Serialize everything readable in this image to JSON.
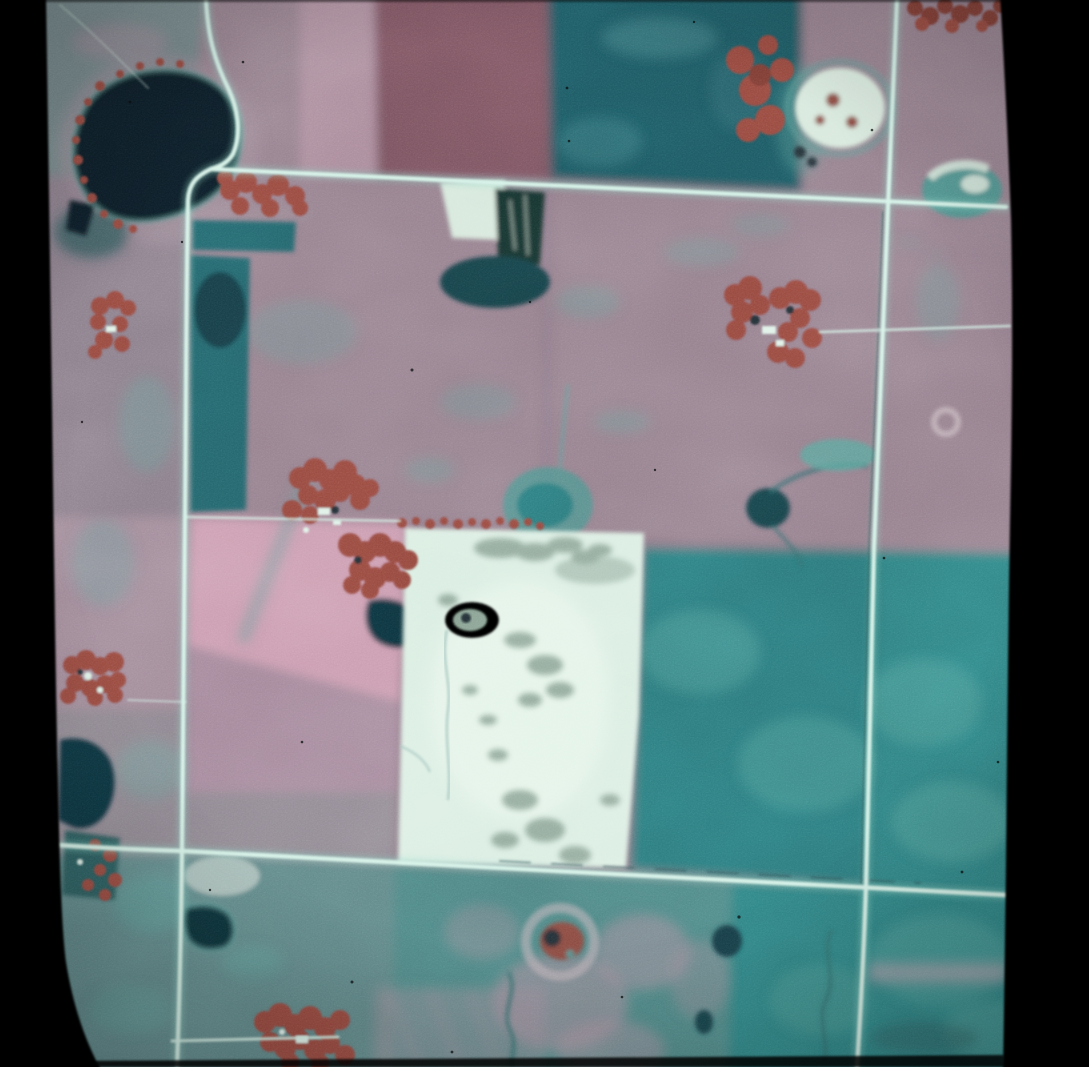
{
  "meta": {
    "type": "false-color infrared aerial photograph (film slide)",
    "description": "Vertical false-color infrared aerial photo of agricultural section-road grid with fields in magenta-mauve and teal tones, a dark kettle lake at upper left, farmstead shelterbelts rendered dark red, sloughs and ponds in dark teal, and one bright white-cream fallow field at center. Black film-mount borders run along the left and right edges.",
    "width_px": 1089,
    "height_px": 1067
  },
  "palette": {
    "base": "#8d7685",
    "grayTeal": "#74878a",
    "mauve": "#957f8d",
    "mauveGray": "#8b7e8b",
    "pinkGray": "#a18a99",
    "pinkPale": "#b492a3",
    "redField": "#7b5260",
    "tealDark": "#1d5962",
    "tealStrip": "#24646b",
    "tealBand": "#2b7a7d",
    "tealBand2": "#2e8283",
    "bottomTeal": "#4d8685",
    "bottomTealGray": "#5f8687",
    "pink": "#cb9cb0",
    "pinkDim": "#a98da0",
    "grayMid": "#8f8791",
    "whiteField": "#dbeee3",
    "whiteBright": "#ecf8ee",
    "mottle": "#87a091",
    "lake": "#0c1f27",
    "lakeSouth": "#10333c",
    "pond": "#123a44",
    "pondDark": "#0d2d35",
    "pondMid": "#153f47",
    "trees": "#96473e",
    "treesDark": "#7e3a33",
    "conifer": "#17332e",
    "farmWhite": "#dff2e8",
    "slough": "#d7e8dc",
    "marsh": "#2c5a5b",
    "palePatch": "#b7c9c3",
    "redBlob": "#8a4940",
    "darkSpot": "#202f35",
    "road": "#d4f2e7",
    "roadGlow": "#8fd8c8",
    "channel": "#2e6a6c",
    "channelLight": "#9fc3bb",
    "fringe": "#5d9b97",
    "shoulder": "#24454a",
    "ringPale": "#c7b6bd",
    "pinkFringe": "#c795aa",
    "tealPatch": "#58a59d",
    "tealBlob": "#4f928e",
    "cloud": "#35747b",
    "pinkMottle": "#b38fa0",
    "paleBand": "#c2a2b0",
    "filmBlack": "#060606"
  },
  "scene": {
    "features": [
      {
        "name": "kettle-lake",
        "desc": "dark lake upper left with red-toned tree fringe"
      },
      {
        "name": "red-crop-field",
        "desc": "dark magenta rectangular field top center"
      },
      {
        "name": "dark-teal-field",
        "desc": "deep teal field top center-right"
      },
      {
        "name": "white-fallow-field",
        "desc": "bright cream field at center with gray-green mottling and small pink-rimmed pond"
      },
      {
        "name": "pink-field",
        "desc": "bright pink field left of the white field"
      },
      {
        "name": "section-roads",
        "desc": "thin pale-cyan gravel roads forming a grid: two horizontal, two vertical, curved segment around the lake"
      },
      {
        "name": "farmstead-shelterbelts",
        "desc": "blocky dark-red tree clusters with small white buildings at several farm sites"
      },
      {
        "name": "sloughs-and-ponds",
        "desc": "dark teal wetlands and ponds scattered through fields"
      },
      {
        "name": "bottom-left-lake",
        "desc": "small dark lake at lower left edge"
      },
      {
        "name": "ring-feature",
        "desc": "pale ring with red-brown center below the white field"
      },
      {
        "name": "film-borders",
        "desc": "black slide-mount borders left and right, thin dark strip at bottom"
      }
    ]
  }
}
